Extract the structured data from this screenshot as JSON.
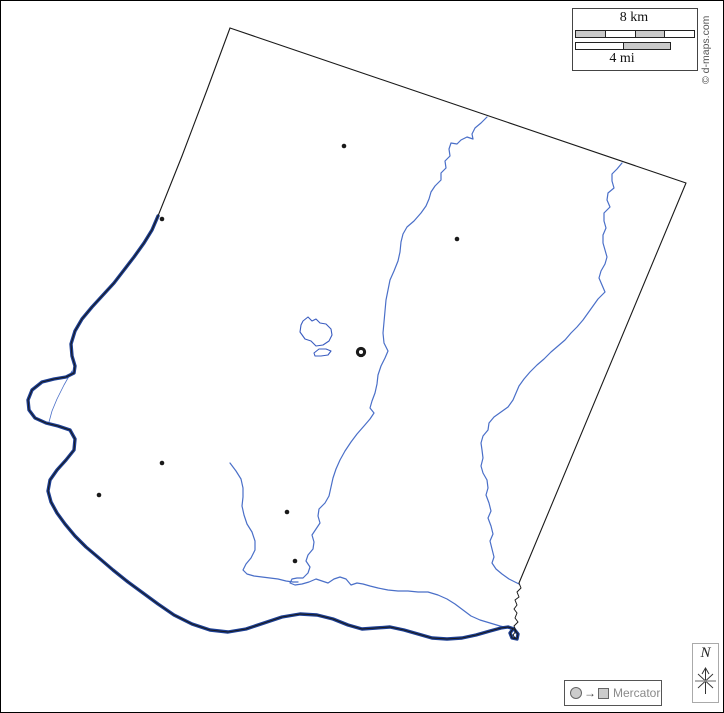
{
  "map": {
    "copyright": "© d-maps.com",
    "scale_bar": {
      "km_label": "8 km",
      "mi_label": "4 mi"
    },
    "compass": {
      "label": "N"
    },
    "projection_legend": {
      "label": "Mercator"
    },
    "colors": {
      "boundary": "#1a1a1a",
      "major_river": "#1d3f94",
      "minor_river": "#4a6fc8",
      "lake_stroke": "#3a5cc0",
      "city_dot": "#1a1a1a"
    },
    "features": {
      "boundary": {
        "straight_borders": [
          "M 230,28 L 207,90 L 182,156 L 158,216",
          "M 230,28 L 686,183 L 519,583"
        ],
        "se_river_border": "M 519,583 L 521,588 L 517,592 L 519,597 L 515,600 L 517,605 L 514,609 L 517,613 L 515,618 L 518,622 L 514,626 L 516,631 L 513,635 L 515,638"
      },
      "major_river": "M 158,216 L 152,230 L 144,243 L 134,257 L 124,270 L 114,283 L 103,295 L 92,307 L 82,319 L 75,331 L 71,344 L 72,356 L 75,366 L 74,373 L 66,377 L 54,379 L 42,382 L 32,390 L 28,400 L 29,410 L 35,418 L 46,423 L 58,426 L 70,430 L 75,439 L 74,450 L 66,460 L 57,470 L 50,480 L 48,491 L 51,502 L 57,513 L 65,524 L 75,536 L 86,547 L 99,558 L 113,570 L 128,582 L 143,593 L 158,604 L 174,615 L 192,624 L 210,630 L 228,632 L 246,629 L 264,623 L 282,617 L 300,614 L 317,615 L 333,619 L 348,625 L 362,629 L 376,628 L 390,627 L 404,630 L 418,634 L 432,638 L 447,639 L 462,638 L 476,635 L 490,631 L 501,628 L 508,627 L 514,629 L 518,634 L 517,639 L 512,638 L 510,633 L 513,629",
      "major_river_old_channel": "M 72,371 L 64,385 L 57,399 L 52,411 L 49,422",
      "minor_rivers": [
        "M 487,117 L 481,123 L 475,128 L 472,134 L 473,139 L 467,137 L 461,140 L 457,144 L 451,143 L 449,149 L 450,156 L 445,161 L 446,168 L 441,173 L 441,180 L 435,186 L 431,192 L 429,199 L 426,206 L 421,213 L 414,221 L 407,227 L 403,234 L 401,242 L 400,252 L 398,261 L 394,271 L 390,280 L 388,290 L 386,300 L 385,311 L 384,322 L 383,333 L 384,343 L 388,351 L 385,358 L 381,366 L 378,375 L 377,384 L 375,393 L 372,401 L 370,408 L 374,413 L 370,419 L 364,426 L 357,434 L 351,442 L 345,451 L 340,460 L 336,469 L 333,478 L 331,487 L 329,496 L 325,503 L 319,509 L 318,516 L 320,523 L 316,529 L 312,535 L 314,542 L 313,549 L 308,555 L 306,561 L 310,567 L 308,573 L 303,578 L 297,578 L 292,579 L 290,583 L 295,585 L 302,584 L 309,582 L 316,579 L 322,581 L 328,583 L 334,579 L 340,577 L 346,579 L 351,585 L 357,583 L 363,584 L 370,586 L 378,588 L 388,590 L 398,591 L 408,591 L 418,592 L 428,592 L 438,595 L 447,599 L 455,604 L 463,610 L 471,616 L 480,620 L 490,623 L 500,626 L 508,628",
        "M 230,463 L 236,471 L 241,479 L 243,488 L 243,497 L 242,506 L 244,515 L 247,524 L 252,532 L 255,541 L 255,550 L 251,558 L 246,564 L 243,570 L 247,574 L 254,576 L 262,577 L 270,578 L 278,579 L 286,581 L 293,582 L 298,582",
        "M 622,163 L 617,169 L 612,174 L 612,181 L 614,188 L 608,193 L 607,200 L 610,207 L 604,213 L 604,221 L 606,228 L 603,235 L 603,243 L 605,250 L 607,257 L 605,264 L 601,271 L 599,278 L 602,285 L 605,292 L 598,299 L 593,306 L 588,313 L 583,320 L 577,327 L 571,333 L 565,340 L 558,346 L 551,352 L 544,359 L 537,365 L 530,372 L 524,379 L 519,386 L 516,393 L 513,400 L 508,407 L 501,412 L 494,417 L 489,423 L 488,430 L 483,436 L 481,443 L 482,450 L 483,458 L 481,466 L 483,473 L 487,480 L 488,488 L 486,495 L 489,503 L 491,511 L 488,518 L 491,526 L 493,534 L 490,541 L 492,549 L 494,557 L 492,563 L 496,569 L 502,574 L 509,579 L 515,582 L 519,584"
      ],
      "lakes": [
        "M 303,321 L 308,317 L 312,321 L 316,319 L 320,323 L 326,324 L 331,329 L 332,335 L 329,341 L 323,345 L 316,346 L 311,341 L 305,339 L 300,332 L 301,325 Z",
        "M 314,353 L 319,349 L 326,349 L 331,351 L 328,355 L 321,356 L 315,356 Z"
      ],
      "city_dots": [
        [
          344,
          146
        ],
        [
          162,
          219
        ],
        [
          457,
          239
        ],
        [
          162,
          463
        ],
        [
          99,
          495
        ],
        [
          287,
          512
        ],
        [
          295,
          561
        ]
      ],
      "county_seat_ring": [
        361,
        352
      ]
    }
  }
}
